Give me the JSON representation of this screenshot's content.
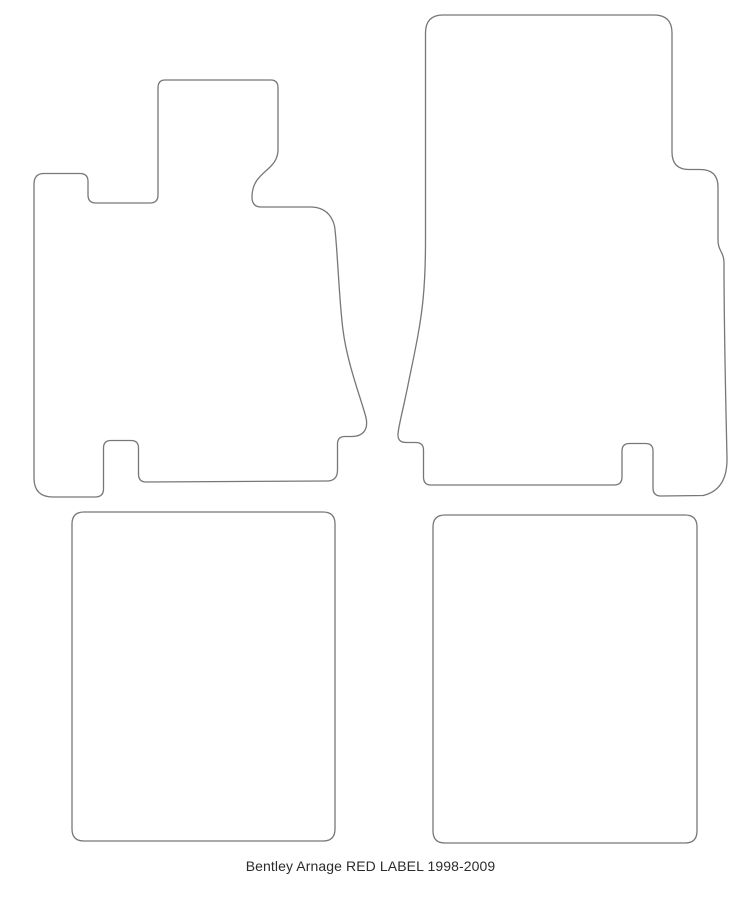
{
  "caption": {
    "text": "Bentley Arnage RED LABEL 1998-2009"
  },
  "diagram": {
    "background_color": "#ffffff",
    "outline_color": "#777777",
    "outline_width": "1.3",
    "paths": {
      "front_left_mat": "M 165 80 L 271 80 Q 278 80 278 88 L 278 148 C 279 172 252 170 252 197 Q 252 207 261 207 L 312 207 Q 330 208 334.5 226 C 337 240 339 300 343 330 C 347 362 360 396 365 414 Q 368.5 425 364.5 431 Q 360.5 436.5 352 436.5 L 345 436.5 Q 337.5 436.5 337.5 444 L 337.5 470 Q 337.5 481 327 481 L 146 482 Q 138.5 482 138.5 474 L 138.5 448 Q 138.5 440.5 131 440.5 L 111 440.5 Q 103.5 440.5 103.5 448 L 103.5 489 Q 103.5 497 95 497 L 53 497 Q 34 497 34 478 L 34 184 Q 34 173.5 44 173.5 L 80 173.5 Q 88 173.5 88 181.5 L 88 195 Q 88 203 96 203 L 150 203 Q 158 203 158 195 L 158 88 Q 158 80 165 80 Z",
      "front_right_mat": "M 443 15 L 654 15 Q 672 15 672 33 L 672 152 Q 672 169.5 689 169.5 L 700 169.5 Q 718 169.5 718 187 L 718 240 C 718 251 724 252 724 263 C 724 330 725.5 390 727 458 Q 727.5 490 703 495.5 L 661 496 Q 653 496 653 488 L 653 451 Q 653 443.5 645.5 443.5 L 629.5 443.5 Q 622 443.5 622 451 L 622 477 Q 622 485 614 485 L 431 485 Q 423.5 485 423.5 477 L 423.5 450 Q 423.5 442.5 415.5 442.5 L 406 442.5 Q 397.5 442.5 398 434 C 398.3 427 403 410 408 385 C 413 360 420 330 423 300 C 425 280 425.5 260 425.5 240 L 425.5 33 Q 425.5 15 443 15 Z",
      "rear_left_mat": "M 84 512 L 323 512 Q 335 512 335 524 L 335 829 Q 335 841 323 841 L 84 841 Q 72 841 72 829 L 72 524 Q 72 512 84 512 Z",
      "rear_right_mat": "M 445 515 L 685 515 Q 697 515 697 527 L 697 831 Q 697 843 685 843 L 445 843 Q 433 843 433 831 L 433 527 Q 433 515 445 515 Z"
    }
  }
}
